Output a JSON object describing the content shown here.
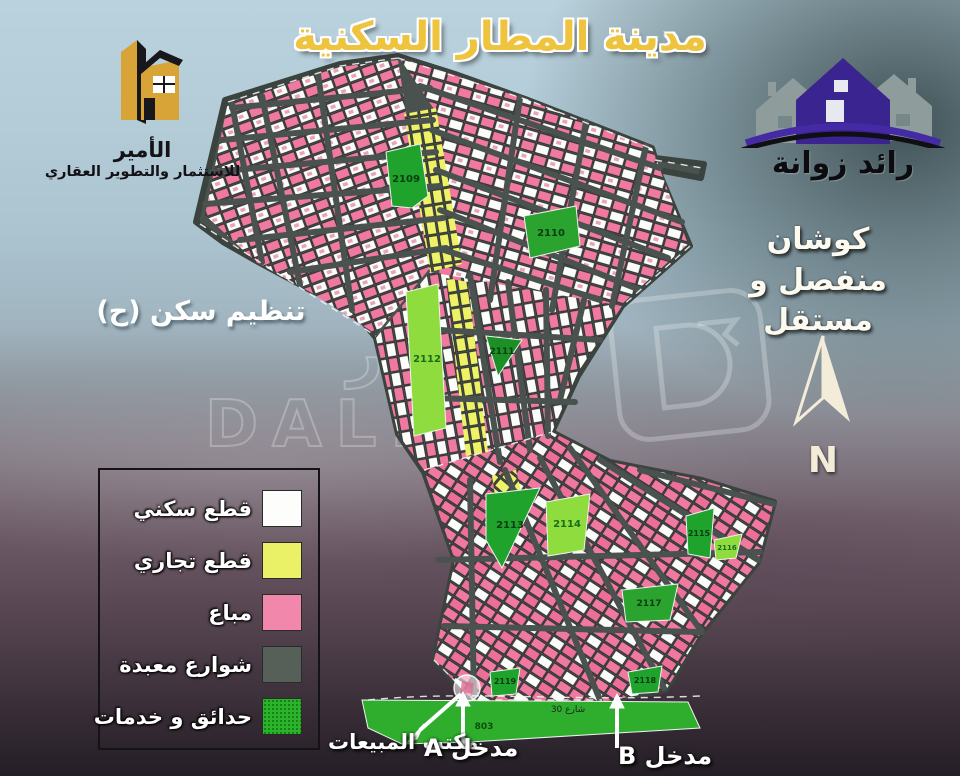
{
  "poster": {
    "title": "مدينة المطار السكنية"
  },
  "developer_logo": {
    "name": "الأمير",
    "subtitle": "للاستثمار والتطوير العقاري"
  },
  "agent_logo": {
    "name": "رائد زوانة"
  },
  "deed_note": {
    "line1": "كوشان",
    "line2": "منفصل و مستقل"
  },
  "zoning_note": {
    "text": "تنظيم سكن (ح)"
  },
  "compass": {
    "label": "N"
  },
  "legend": {
    "items": [
      {
        "label": "قطع سكني",
        "color": "#fdfdfb"
      },
      {
        "label": "قطع تجاري",
        "color": "#eaf166"
      },
      {
        "label": "مباع",
        "color": "#f287ac"
      },
      {
        "label": "شوارع معبدة",
        "color": "#566059"
      },
      {
        "label": "حدائق و خدمات",
        "color": "#2bb32b"
      }
    ]
  },
  "map": {
    "street_label": "شارع 30",
    "green_areas": [
      {
        "label": "2109"
      },
      {
        "label": "2110"
      },
      {
        "label": "2111"
      },
      {
        "label": "2112"
      },
      {
        "label": "2113"
      },
      {
        "label": "2114"
      },
      {
        "label": "2115"
      },
      {
        "label": "2116"
      },
      {
        "label": "2117"
      },
      {
        "label": "2118"
      },
      {
        "label": "2119"
      },
      {
        "label": "803"
      }
    ]
  },
  "annotations": {
    "sales_office": "مكتب المبيعات",
    "entrance_a": "مدخل A",
    "entrance_b": "مدخل B"
  },
  "watermark": {
    "arabic": "العقــار",
    "latin": "DALEEL"
  }
}
